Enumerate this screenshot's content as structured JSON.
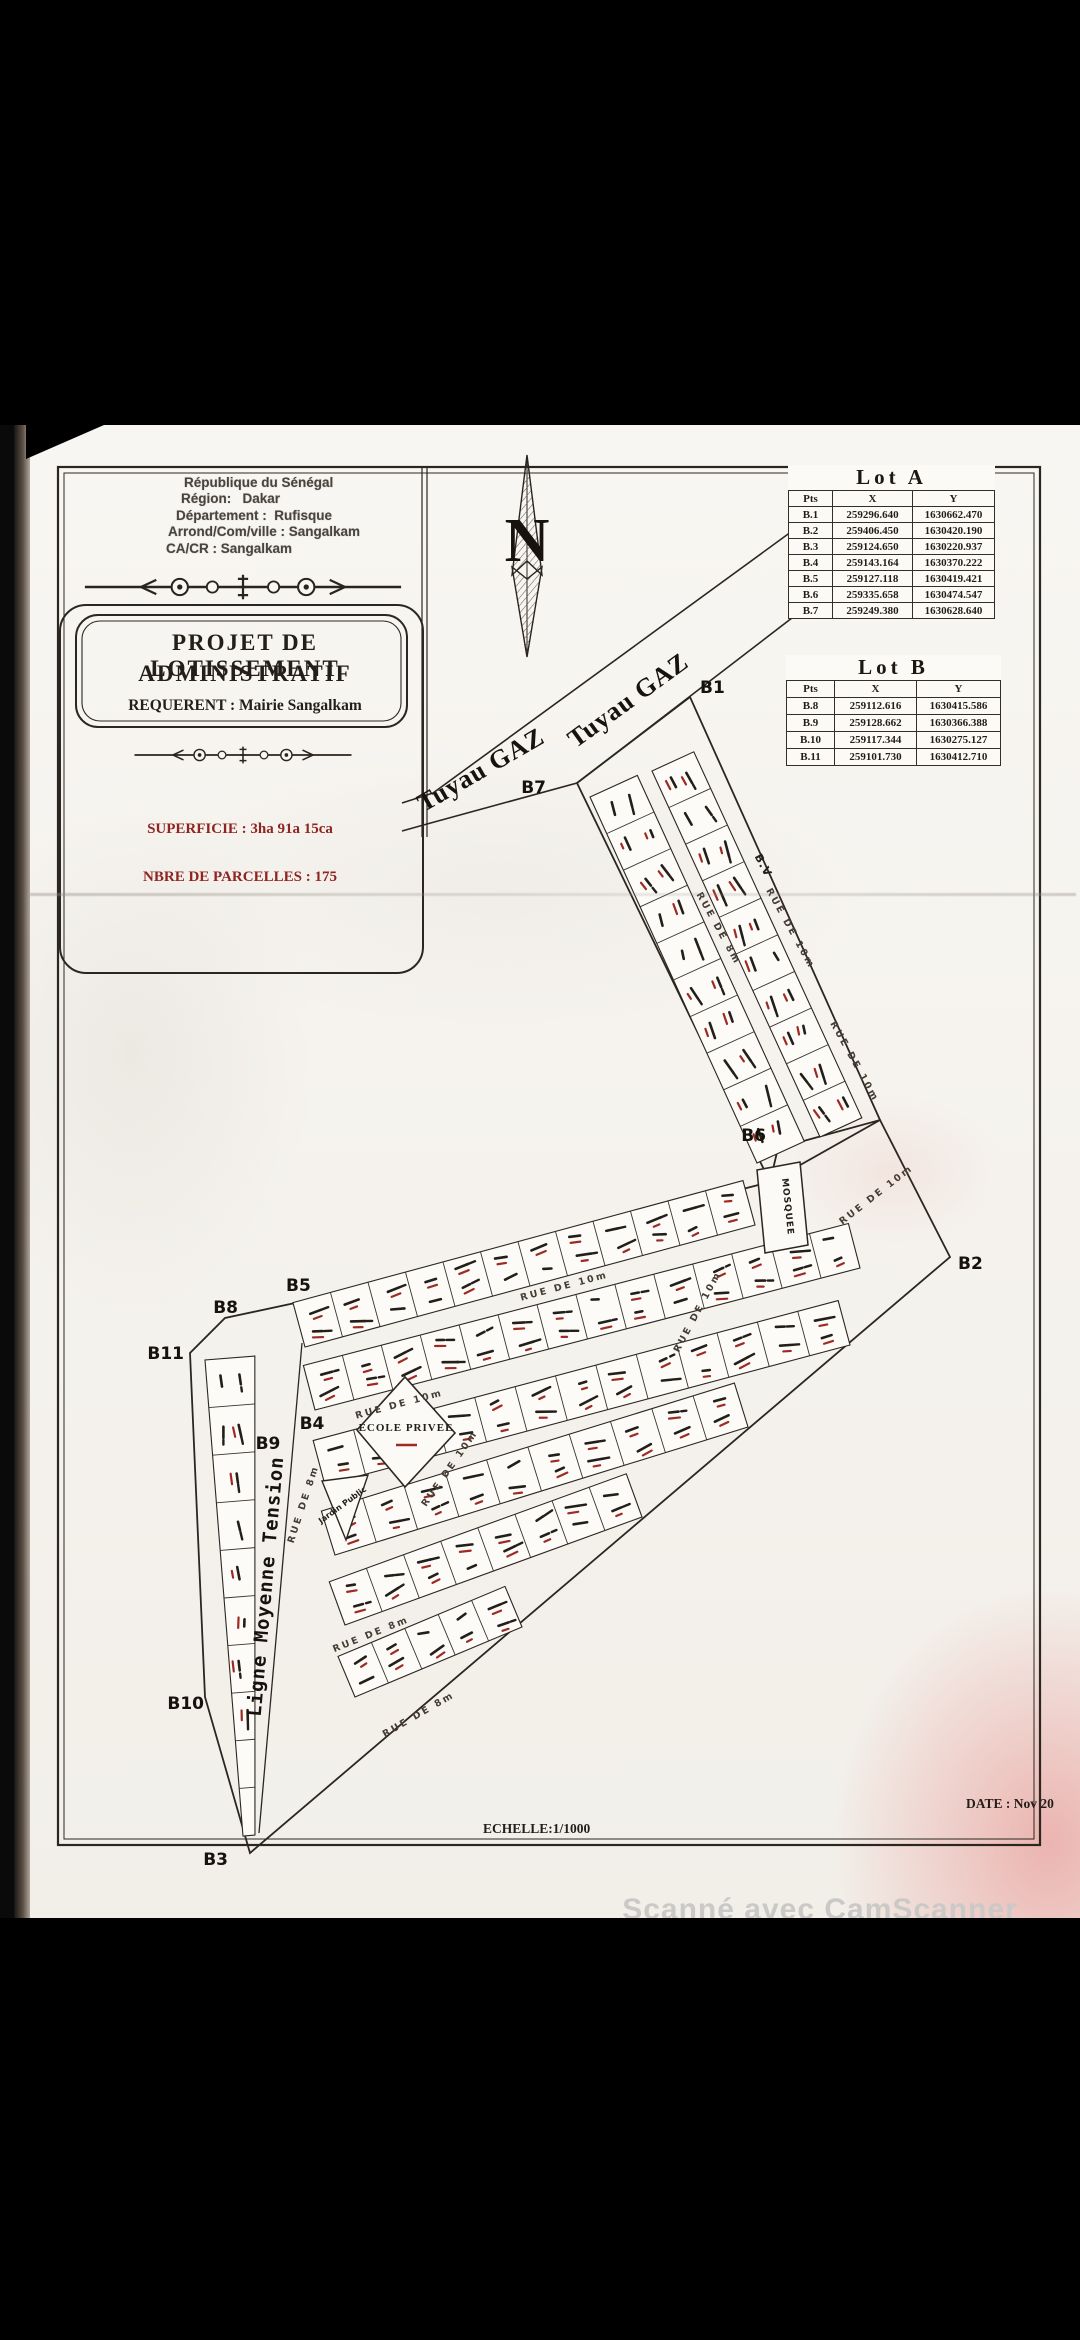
{
  "admin_block": {
    "line1": "République du Sénégal",
    "line2_label": "Région:",
    "line2_value": "Dakar",
    "line3_label": "Département :",
    "line3_value": "Rufisque",
    "line4_label": "Arrond/Com/ville :",
    "line4_value": "Sangalkam",
    "line5_label": "CA/CR :",
    "line5_value": "Sangalkam"
  },
  "title_box": {
    "line1": "PROJET  DE  LOTISSEMENT",
    "line2": "ADMINISTRATIF",
    "requerent": "REQUERENT : Mairie Sangalkam"
  },
  "details": {
    "superficie": "SUPERFICIE :  3ha 91a  15ca",
    "parcelles": "NBRE DE PARCELLES : 175"
  },
  "north_arrow": {
    "label": "N"
  },
  "lot_a": {
    "title": "Lot A",
    "headers": [
      "Pts",
      "X",
      "Y"
    ],
    "rows": [
      [
        "B.1",
        "259296.640",
        "1630662.470"
      ],
      [
        "B.2",
        "259406.450",
        "1630420.190"
      ],
      [
        "B.3",
        "259124.650",
        "1630220.937"
      ],
      [
        "B.4",
        "259143.164",
        "1630370.222"
      ],
      [
        "B.5",
        "259127.118",
        "1630419.421"
      ],
      [
        "B.6",
        "259335.658",
        "1630474.547"
      ],
      [
        "B.7",
        "259249.380",
        "1630628.640"
      ]
    ]
  },
  "lot_b": {
    "title": "Lot B",
    "headers": [
      "Pts",
      "X",
      "Y"
    ],
    "rows": [
      [
        "B.8",
        "259112.616",
        "1630415.586"
      ],
      [
        "B.9",
        "259128.662",
        "1630366.388"
      ],
      [
        "B.10",
        "259117.344",
        "1630275.127"
      ],
      [
        "B.11",
        "259101.730",
        "1630412.710"
      ]
    ]
  },
  "map": {
    "gas_line_label_upper": "Tuyau GAZ",
    "gas_line_label_lower": "Tuyau GAZ",
    "power_line_label": "Ligne Moyenne Tension",
    "school_label": "ECOLE PRIVEE",
    "mosque_label": "MOSQUEE",
    "garden_label": "Jardin Public",
    "bv_label": "B.V",
    "boundary_labels": {
      "b1": "B1",
      "b2": "B2",
      "b3": "B3",
      "b4": "B4",
      "b5": "B5",
      "b6": "B6",
      "b7": "B7",
      "b8": "B8",
      "b9": "B9",
      "b10": "B10",
      "b11": "B11"
    },
    "street_labels": [
      "RUE DE 8m",
      "RUE DE 10m",
      "RUE DE 10m",
      "RUE DE 10m",
      "RUE DE 10m",
      "RUE DE 10m",
      "RUE DE 8m",
      "RUE DE 8m",
      "RUE DE 8m",
      "RUE DE 10m",
      "RUE DE 10m"
    ]
  },
  "footer": {
    "scale": "ECHELLE:1/1000",
    "date": "DATE : Nov 20"
  },
  "watermark": "Scanné avec CamScanner",
  "colors": {
    "ink": "#241e18",
    "red_accent": "#8f2420",
    "paper": "#f6f4ef"
  }
}
